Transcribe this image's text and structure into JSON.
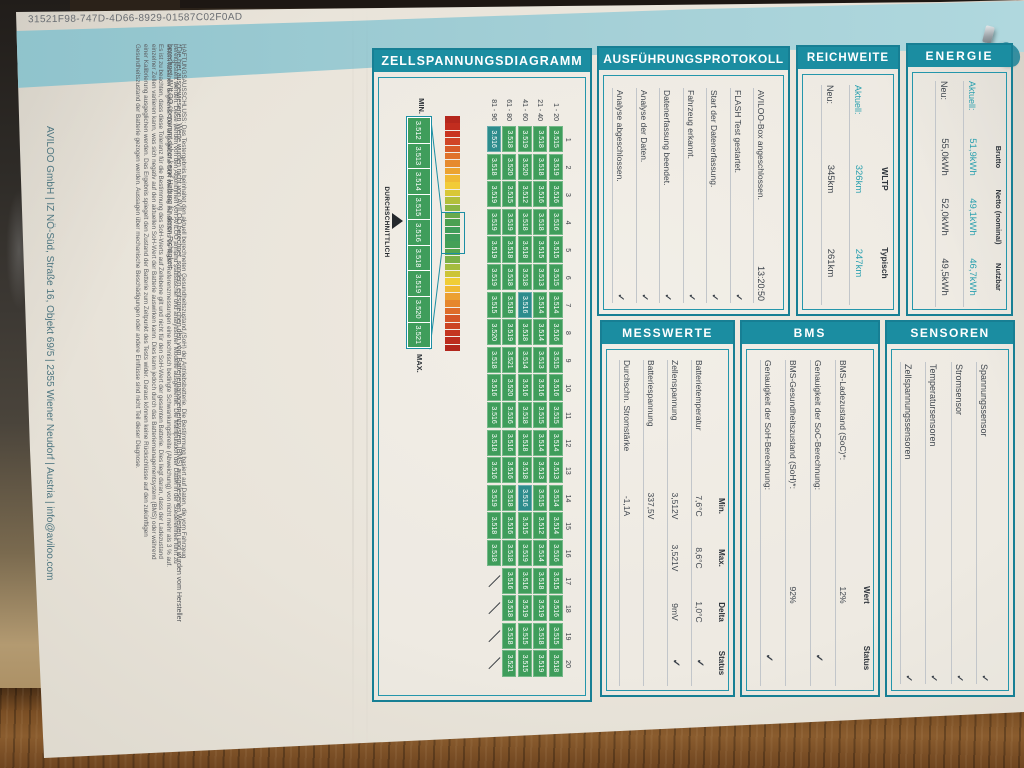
{
  "page": {
    "document_id": "31521F98-747D-4D66-8929-01587C02F0AD",
    "footer": "AVILOO GmbH | IZ NÖ-Süd, Straße 16, Objekt 69/5 | 2355 Wiener Neudorf | Austria | info@aviloo.com",
    "footnote_lines": [
      "*Die hier ausgewiesenen Werte wurden nicht von AVILOO berechnet, sondern entsprechen den vom Batteriemanagementsystem (BMS) ausgelesenen Werten und wurden vom Hersteller",
      "berechnet. AVILOO übernimmt daher keine Haftung für deren Richtigkeit."
    ],
    "disclaimer_lines": [
      "HAFTUNGSAUSSCHLUSS: Das Testergebnis beinhaltet den aktuell berechneten Gesundheitszustand (SoH) der Antriebsbatterie. Die Bestimmung basiert auf Daten, die vom Fahrzeug",
      "bereitgestellt werden. Diese werden von den Algorithmen von AVILOO anhand statistischer und analytischer Modelle ausgewertet. Die Manipulation der Daten in der Steuereinheit führt zu",
      "einem falschen Ergebnis. Der angegebene SoH weist bei mindestens 95 % der Referenzmessungen eine technisch bedingte Schwankungsbreite (Abweichung) von nicht mehr als 3 % auf.",
      "Es ist zu beachten, dass diese Toleranz für die Bestimmung des SoH-Werts auf Zellebene gilt und nicht für den SoH-Wert der gesamten Batterie. Dies liegt daran, dass der Ladezustand",
      "einzelner Zellen variieren kann, was sich negativ auf den aktuellen SoH-Wert der Batterie auswirken kann. Dies kann jedoch durch das Batteriemanagementsystem (BMS) oder während",
      "einer Kalibrierung ausgeglichen werden. Das Ergebnis spiegelt den Zustand der Batterie zum Zeitpunkt des Tests wider. Daraus können keine Rückschlüsse auf den zukünftigen",
      "Gesundheitszustand der Batterie gezogen werden. Aussagen über mechanische Beschädigungen oder andere Einflüsse sind nicht Teil dieser Diagnose."
    ]
  },
  "glyphs": {
    "check": "✓"
  },
  "colors": {
    "teal": "#1b8da1",
    "band": "#9ccbd3",
    "cell_green": "#3f9d5b",
    "cell_teal": "#2d8c8c",
    "accent": "#2aa0af"
  },
  "sections": {
    "ausfuehrungsprotokoll": {
      "title": "AUSFÜHRUNGSPROTOKOLL",
      "items": [
        {
          "label": "AVILOO-Box angeschlossen.",
          "value": "13:20:50",
          "check": false
        },
        {
          "label": "FLASH Test gestartet.",
          "value": "",
          "check": true
        },
        {
          "label": "Start der Datenerfassung.",
          "value": "",
          "check": true
        },
        {
          "label": "Fahrzeug erkannt.",
          "value": "",
          "check": true
        },
        {
          "label": "Datenerfassung beendet.",
          "value": "",
          "check": true
        },
        {
          "label": "Analyse der Daten.",
          "value": "",
          "check": true
        },
        {
          "label": "Analyse abgeschlossen.",
          "value": "",
          "check": true
        }
      ]
    },
    "reichweite": {
      "title": "REICHWEITE",
      "columns": [
        "WLTP",
        "Typisch"
      ],
      "rows": [
        {
          "label": "Aktuell:",
          "values": [
            "326km",
            "247km"
          ],
          "accent": true
        },
        {
          "label": "Neu:",
          "values": [
            "345km",
            "261km"
          ],
          "accent": false
        }
      ]
    },
    "energie": {
      "title": "ENERGIE",
      "columns": [
        "Brutto",
        "Netto (nominal)",
        "Nutzbar"
      ],
      "rows": [
        {
          "label": "Aktuell:",
          "values": [
            "51,9kWh",
            "49,1kWh",
            "46,7kWh"
          ],
          "accent": true
        },
        {
          "label": "Neu:",
          "values": [
            "55,0kWh",
            "52,0kWh",
            "49,5kWh"
          ],
          "accent": false
        }
      ]
    },
    "messwerte": {
      "title": "MESSWERTE",
      "columns": [
        "Min.",
        "Max.",
        "Delta",
        "Status"
      ],
      "rows": [
        {
          "label": "Batterietemperatur",
          "values": [
            "7,6°C",
            "8,6°C",
            "1,0°C"
          ],
          "check": true
        },
        {
          "label": "Zellenspannung",
          "values": [
            "3,512V",
            "3,521V",
            "9mV"
          ],
          "check": true
        },
        {
          "label": "Batteriespannung",
          "values": [
            "337,5V",
            "",
            ""
          ],
          "check": false
        },
        {
          "label": "Durchschn. Stromstärke",
          "values": [
            "-1,1A",
            "",
            ""
          ],
          "check": false
        }
      ]
    },
    "bms": {
      "title": "BMS",
      "columns": [
        "Wert",
        "Status"
      ],
      "rows": [
        {
          "label": "BMS-Ladezustand (SoC)*:",
          "wert": "12%",
          "check": false
        },
        {
          "label": "Genauigkeit der SoC-Berechnung:",
          "wert": "",
          "check": true
        },
        {
          "label": "BMS-Gesundheitszustand (SoH)*:",
          "wert": "92%",
          "check": false
        },
        {
          "label": "Genauigkeit der SoH-Berechnung:",
          "wert": "",
          "check": true
        }
      ]
    },
    "sensoren": {
      "title": "SENSOREN",
      "items": [
        {
          "label": "Spannungssensor",
          "check": true
        },
        {
          "label": "Stromsensor",
          "check": true
        },
        {
          "label": "Temperatursensoren",
          "check": true
        },
        {
          "label": "Zellspannungssensoren",
          "check": true
        }
      ]
    }
  },
  "chart_data": {
    "type": "heatmap",
    "title": "ZELLSPANNUNGSDIAGRAMM",
    "min_label": "MIN.",
    "max_label": "MAX.",
    "avg_label": "DURCHSCHNITTLICH",
    "avg_between": [
      "3.515",
      "3.516"
    ],
    "legend_values": [
      "3.512",
      "3.513",
      "3.514",
      "3.515",
      "3.516",
      "3.518",
      "3.519",
      "3.520",
      "3.521"
    ],
    "col_numbers": [
      1,
      2,
      3,
      4,
      5,
      6,
      7,
      8,
      9,
      10,
      11,
      12,
      13,
      14,
      15,
      16,
      17,
      18,
      19,
      20
    ],
    "groups": [
      {
        "label": "1 - 20",
        "values": [
          "3.515",
          "3.519",
          "3.516",
          "3.516",
          "3.515",
          "3.515",
          "3.514",
          "3.516",
          "3.515",
          "3.516",
          "3.515",
          "3.514",
          "3.513",
          "3.514",
          "3.514",
          "3.516",
          "3.515",
          "3.516",
          "3.515",
          "3.518"
        ]
      },
      {
        "label": "21 - 40",
        "values": [
          "3.518",
          "3.518",
          "3.516",
          "3.518",
          "3.515",
          "3.513",
          "3.514",
          "3.514",
          "3.513",
          "3.516",
          "3.515",
          "3.514",
          "3.513",
          "3.515",
          "3.512",
          "3.514",
          "3.518",
          "3.519",
          "3.518",
          "3.519"
        ]
      },
      {
        "label": "41 - 60",
        "values": [
          "3.519",
          "3.520",
          "3.512",
          "3.518",
          "3.518",
          "3.518",
          "3.516",
          "3.518",
          "3.514",
          "3.516",
          "3.518",
          "3.518",
          "3.518",
          "3.516",
          "3.515",
          "3.519",
          "3.516",
          "3.519",
          "3.515",
          "3.515"
        ]
      },
      {
        "label": "61 - 80",
        "values": [
          "3.518",
          "3.520",
          "3.515",
          "3.519",
          "3.518",
          "3.518",
          "3.518",
          "3.519",
          "3.521",
          "3.520",
          "3.516",
          "3.516",
          "3.516",
          "3.518",
          "3.516",
          "3.518",
          "3.516",
          "3.518",
          "3.518",
          "3.521"
        ]
      },
      {
        "label": "81 - 96",
        "values": [
          "3.516",
          "3.518",
          "3.519",
          "3.519",
          "3.519",
          "3.519",
          "3.515",
          "3.520",
          "3.518",
          "3.516",
          "3.516",
          "3.518",
          "3.516",
          "3.519",
          "3.518",
          "3.518",
          null,
          null,
          null,
          null
        ]
      }
    ],
    "highlight_cells": [
      {
        "group": 2,
        "col": 6
      },
      {
        "group": 2,
        "col": 13
      },
      {
        "group": 4,
        "col": 0
      }
    ],
    "scale_colors": [
      "#b5271d",
      "#c22d1f",
      "#c93520",
      "#d04526",
      "#d85c28",
      "#e0722b",
      "#e68a2e",
      "#eca331",
      "#f0ba34",
      "#f2cb37",
      "#d9c736",
      "#b3bf3b",
      "#8cb544",
      "#68aa4c",
      "#4ba052",
      "#3f9d5b",
      "#3f9d5b",
      "#44a057",
      "#55a54f",
      "#7bb047",
      "#a5bc3e",
      "#ccc438",
      "#f0cd36",
      "#f0b933",
      "#eca031",
      "#e6862d",
      "#de6c2a",
      "#d55527",
      "#cc4423",
      "#c43520",
      "#bc2c1e",
      "#b2261c"
    ]
  }
}
